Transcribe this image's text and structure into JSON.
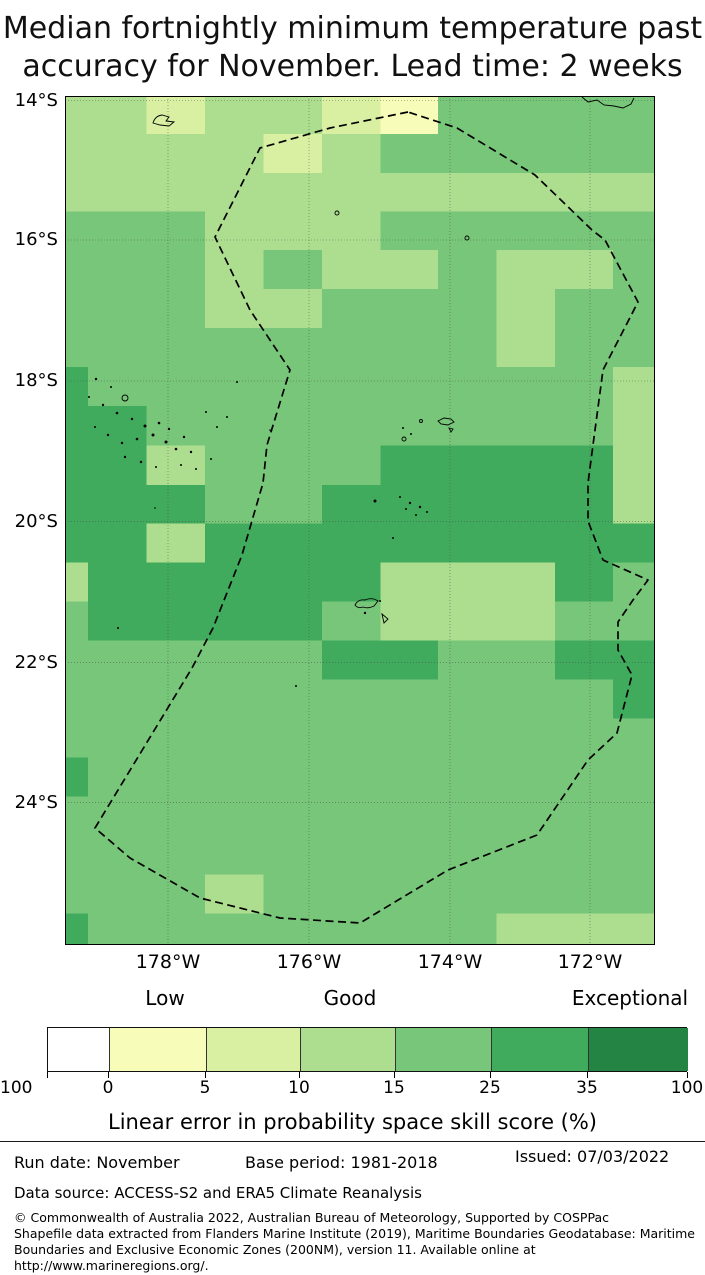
{
  "title": {
    "line1": "Median fortnightly minimum temperature past",
    "line2": "accuracy for November. Lead time: 2 weeks"
  },
  "map": {
    "width": 590,
    "height": 849,
    "palette": {
      "Y": "#f7fcb9",
      "P": "#d9f0a3",
      "L": "#addd8e",
      "M": "#78c679",
      "D": "#41ab5d"
    },
    "col_edges": [
      0,
      23,
      81.5,
      140,
      198.5,
      257,
      315.5,
      373,
      431.5,
      490,
      548,
      590
    ],
    "row_edges": [
      0,
      38,
      77,
      115.5,
      154,
      193,
      232,
      271,
      310,
      349.5,
      389,
      427.5,
      466.5,
      505.5,
      544.5,
      583.5,
      622.5,
      661.5,
      700.5,
      739.5,
      778.5,
      817.5,
      849
    ],
    "grid": [
      "LLPLLPYMMMM",
      "LLLLPLMMMMM",
      "LLLLLLLLLLL",
      "MMMLLLMMMMM",
      "MMMLMLLMLLM",
      "MMMLLMMMLMM",
      "MMMMMMMMLMM",
      "DMMMMMMMMML",
      "DDMMMMMMMML",
      "DDLMMMDDDDL",
      "DDDMMDDDDDL",
      "DDLDDDDDDDD",
      "LDDDDDLLLDM",
      "MDDDDMLLLMM",
      "MMMMMDDMMDD",
      "MMMMMMMMMMD",
      "MMMMMMMMMMM",
      "DMMMMMMMMMM",
      "MMMMMMMMMMM",
      "MMMMMMMMMMM",
      "MMMLMMMMMMM",
      "DMMMMMMMLLL"
    ],
    "lat_lines": [
      {
        "label": "14°S",
        "y": 4.5
      },
      {
        "label": "16°S",
        "y": 144
      },
      {
        "label": "18°S",
        "y": 285
      },
      {
        "label": "20°S",
        "y": 425.7
      },
      {
        "label": "22°S",
        "y": 566.7
      },
      {
        "label": "24°S",
        "y": 706.7
      }
    ],
    "lon_lines": [
      {
        "label": "178°W",
        "x": 103
      },
      {
        "label": "176°W",
        "x": 244
      },
      {
        "label": "174°W",
        "x": 385
      },
      {
        "label": "172°W",
        "x": 525
      }
    ],
    "eez_boundary": [
      [
        343,
        16
      ],
      [
        265,
        32
      ],
      [
        195,
        52
      ],
      [
        150,
        141
      ],
      [
        185,
        214
      ],
      [
        225,
        274
      ],
      [
        202,
        349
      ],
      [
        198,
        387
      ],
      [
        177,
        459
      ],
      [
        148,
        532
      ],
      [
        127,
        572
      ],
      [
        30,
        732
      ],
      [
        65,
        762
      ],
      [
        135,
        802
      ],
      [
        215,
        822
      ],
      [
        295,
        827
      ],
      [
        383,
        774
      ],
      [
        472,
        739
      ],
      [
        523,
        664
      ],
      [
        552,
        637
      ],
      [
        567,
        579
      ],
      [
        553,
        554
      ],
      [
        553,
        526
      ],
      [
        568,
        504
      ],
      [
        583,
        484
      ],
      [
        538,
        464
      ],
      [
        523,
        425
      ],
      [
        523,
        387
      ],
      [
        528,
        349
      ],
      [
        538,
        274
      ],
      [
        573,
        206
      ],
      [
        540,
        144
      ],
      [
        527,
        134
      ],
      [
        470,
        79
      ],
      [
        392,
        32
      ],
      [
        343,
        16
      ]
    ],
    "island_outlines": [
      "M88,27 q2,-7 9,-8 l7,2 -3,4 8,1 -5,4 -9,-1 -7,-2 z",
      "M517,1 L523,6 L532,4 L539,9 L549,10 L558,12 L566,8 L569,2",
      "M290,509 q3,-6 10,-5 q7,-3 13,1 l-4,5 q-6,3 -11,1 q-5,2 -8,-2 z",
      "M317,518 l2,9 4,-4 z",
      "M373,325 l6,-3 7,1 3,3 -6,3 -7,-1 z",
      "M384,332 l4,1 -2,3 z"
    ],
    "island_rings": [
      [
        60,
        302,
        3
      ],
      [
        272,
        117,
        2
      ],
      [
        402,
        142,
        2
      ],
      [
        339,
        343,
        2
      ],
      [
        356,
        325,
        1.5
      ]
    ],
    "island_dots": [
      [
        31,
        283,
        1.2
      ],
      [
        46,
        291,
        1
      ],
      [
        24,
        301,
        1
      ],
      [
        38,
        309,
        1.2
      ],
      [
        52,
        317,
        1.3
      ],
      [
        67,
        323,
        1.2
      ],
      [
        80,
        330,
        1.5
      ],
      [
        94,
        327,
        1.3
      ],
      [
        88,
        339,
        1.5
      ],
      [
        72,
        343,
        1.3
      ],
      [
        57,
        347,
        1.2
      ],
      [
        43,
        339,
        1.2
      ],
      [
        30,
        331,
        1
      ],
      [
        101,
        346,
        1.5
      ],
      [
        111,
        353,
        1.3
      ],
      [
        119,
        341,
        1.2
      ],
      [
        104,
        333,
        1.2
      ],
      [
        126,
        356,
        1.2
      ],
      [
        60,
        361,
        1.2
      ],
      [
        76,
        366,
        1.2
      ],
      [
        91,
        371,
        1
      ],
      [
        116,
        369,
        1
      ],
      [
        131,
        373,
        1
      ],
      [
        146,
        363,
        1
      ],
      [
        152,
        331,
        1
      ],
      [
        162,
        321,
        1
      ],
      [
        141,
        316,
        1
      ],
      [
        172,
        286,
        1
      ],
      [
        205,
        334,
        0.8
      ],
      [
        338,
        332,
        1
      ],
      [
        346,
        338,
        1
      ],
      [
        335,
        401,
        1
      ],
      [
        345,
        407,
        1.2
      ],
      [
        355,
        411,
        1.2
      ],
      [
        362,
        416,
        1
      ],
      [
        351,
        419,
        1
      ],
      [
        341,
        413,
        1
      ],
      [
        310,
        405,
        1.5
      ],
      [
        328,
        442,
        1
      ],
      [
        300,
        517,
        1.2
      ],
      [
        315,
        505,
        1
      ],
      [
        231,
        590,
        1
      ],
      [
        90,
        412,
        0.8
      ],
      [
        53,
        532,
        1
      ]
    ]
  },
  "colorbar": {
    "zone_labels": [
      {
        "text": "Low",
        "x": 165
      },
      {
        "text": "Good",
        "x": 350
      },
      {
        "text": "Exceptional",
        "x": 630
      }
    ],
    "segments": [
      {
        "color": "#ffffff",
        "x0": 47,
        "x1": 108
      },
      {
        "color": "#f7fcb9",
        "x0": 108,
        "x1": 205
      },
      {
        "color": "#d9f0a3",
        "x0": 205,
        "x1": 299
      },
      {
        "color": "#addd8e",
        "x0": 299,
        "x1": 394
      },
      {
        "color": "#78c679",
        "x0": 394,
        "x1": 490
      },
      {
        "color": "#41ab5d",
        "x0": 490,
        "x1": 587
      },
      {
        "color": "#238443",
        "x0": 587,
        "x1": 687
      }
    ],
    "ticks": [
      {
        "label": "100",
        "x": 47
      },
      {
        "label": "0",
        "x": 108
      },
      {
        "label": "5",
        "x": 205
      },
      {
        "label": "10",
        "x": 299
      },
      {
        "label": "15",
        "x": 394
      },
      {
        "label": "25",
        "x": 490
      },
      {
        "label": "35",
        "x": 587
      },
      {
        "label": "100",
        "x": 687
      }
    ],
    "axis_label": "Linear error in probability space skill score (%)"
  },
  "footer": {
    "run_date": "Run date: November",
    "base_period": "Base period: 1981-2018",
    "issued": "Issued: 07/03/2022",
    "data_source": "Data source: ACCESS-S2 and ERA5 Climate Reanalysis",
    "copyright_lines": [
      "© Commonwealth of Australia 2022, Australian Bureau of Meteorology, Supported by COSPPac",
      "Shapefile data extracted from Flanders Marine Institute (2019), Maritime Boundaries Geodatabase: Maritime",
      "Boundaries and Exclusive Economic Zones (200NM), version 11. Available online at",
      "http://www.marineregions.org/."
    ]
  }
}
